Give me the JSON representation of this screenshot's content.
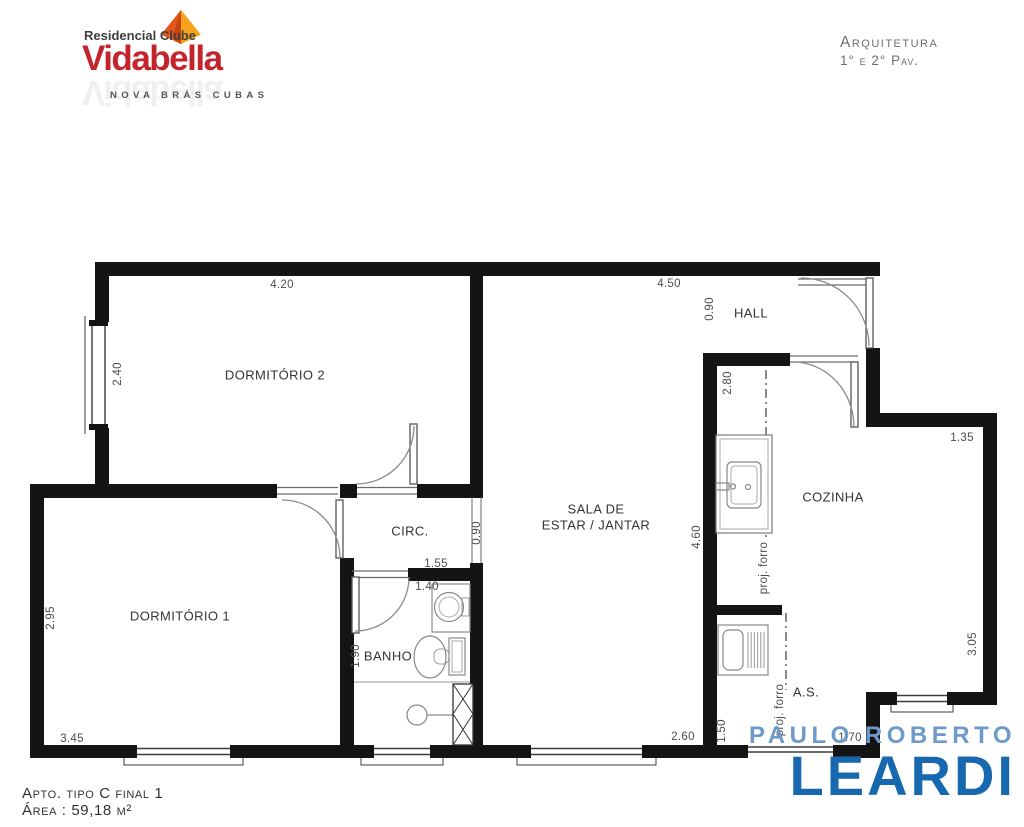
{
  "header": {
    "logo": {
      "line1": "Residencial Clube",
      "brand": "Vidabella",
      "subtitle": "NOVA BRÁS CUBAS"
    },
    "title_block": {
      "line1": "Arquitetura",
      "line2": "1° e 2° Pav."
    }
  },
  "plan": {
    "rooms": {
      "dormitorio2": "DORMITÓRIO 2",
      "dormitorio1": "DORMITÓRIO 1",
      "circ": "CIRC.",
      "banho": "BANHO",
      "sala_line1": "SALA DE",
      "sala_line2": "ESTAR / JANTAR",
      "hall": "HALL",
      "cozinha": "COZINHA",
      "area_servico": "A.S."
    },
    "dims": {
      "dorm2_width": "4.20",
      "dorm2_window": "2.40",
      "sala_width": "4.50",
      "hall_depth": "0.90",
      "cozinha_door_wall": "2.80",
      "cozinha_notch": "1.35",
      "circ_opening": "0.90",
      "sala_depth": "4.60",
      "dorm1_depth": "2.95",
      "dorm1_width": "3.45",
      "banho_width_top": "1.55",
      "banho_width": "1.40",
      "banho_depth": "1.90",
      "sala_window": "2.60",
      "as_width": "1.50",
      "as_bottom": "1.70",
      "cozinha_depth": "3.05",
      "proj_forro": "proj. forro"
    }
  },
  "footer": {
    "apto": "Apto. tipo C final 1",
    "area": "Área : 59,18 m²",
    "agency_line1": "PAULO ROBERTO",
    "agency_line2": "LEARDI"
  },
  "colors": {
    "brand_red": "#c4242b",
    "kite_orange": "#f7a21d",
    "kite_dark": "#e2581c",
    "leardi_blue": "#1768ae",
    "leardi_light_blue": "#6d9ac9",
    "wall_black": "#141414"
  }
}
